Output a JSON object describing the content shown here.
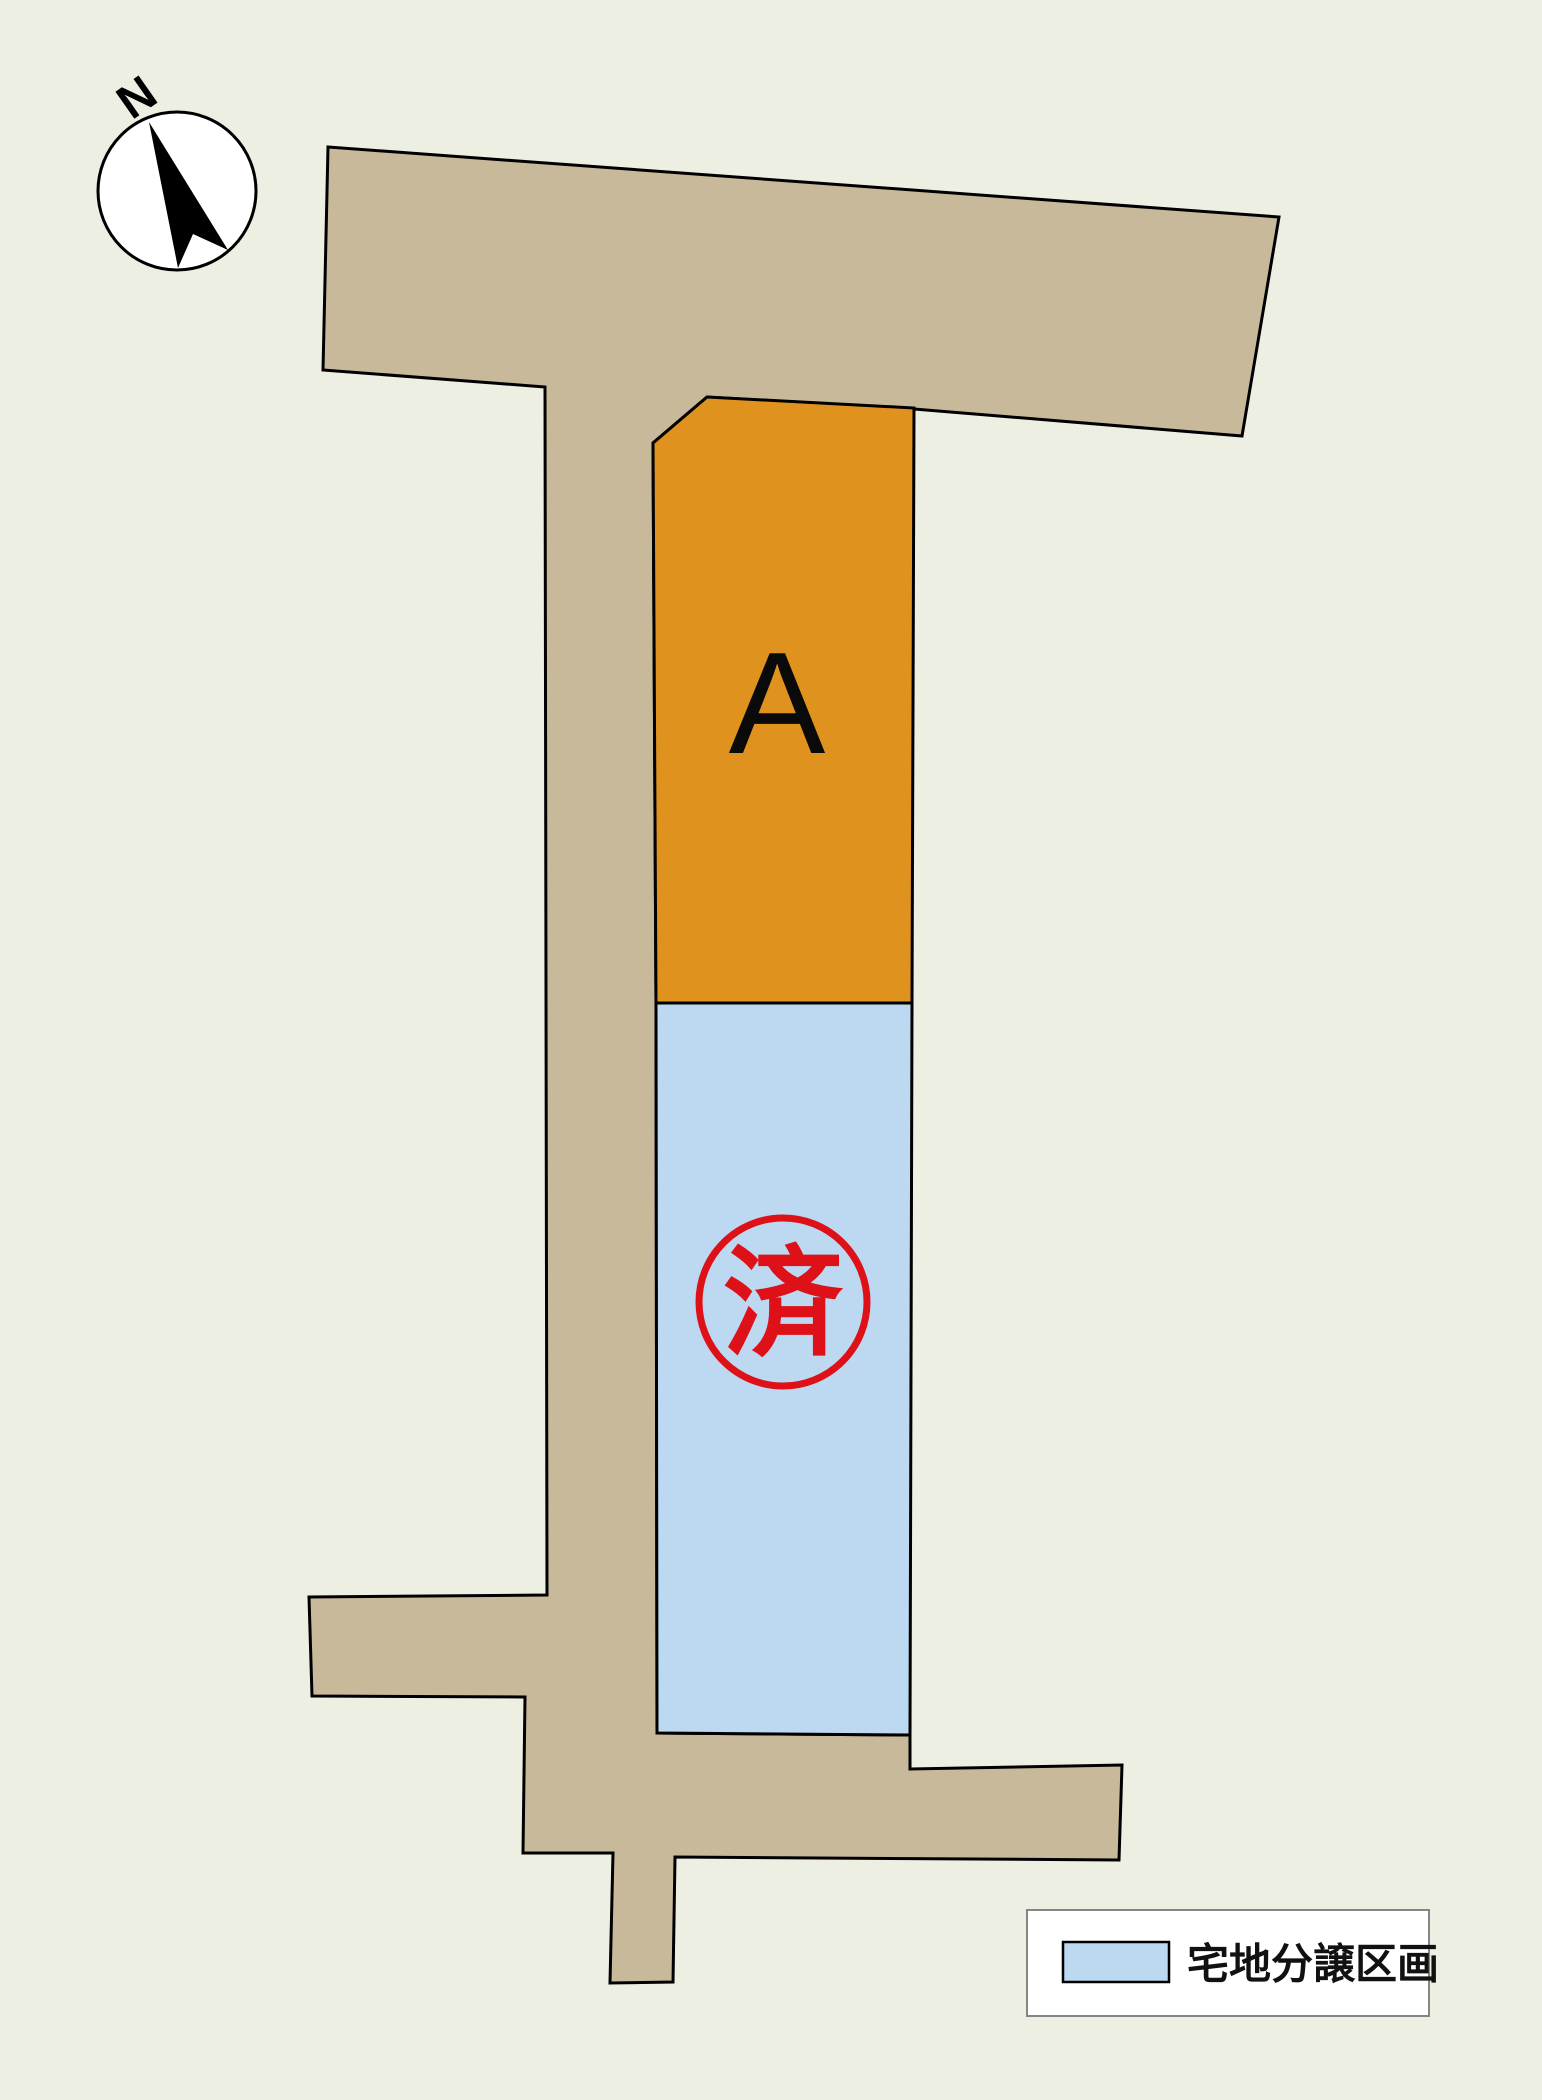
{
  "map": {
    "compass": {
      "label": "N"
    },
    "lots": [
      {
        "id": "A",
        "label": "A",
        "fill": "#E0921F"
      },
      {
        "id": "sold",
        "stamp": "済",
        "fill": "#BCD9F1"
      }
    ],
    "legend": {
      "label": "宅地分譲区画",
      "swatch_color": "#BCD9F1"
    },
    "colors": {
      "background": "#ECEFE1",
      "road": "#C9B99B",
      "outline": "#000000",
      "stamp_red": "#DE1018",
      "legend_border": "#858585"
    }
  }
}
